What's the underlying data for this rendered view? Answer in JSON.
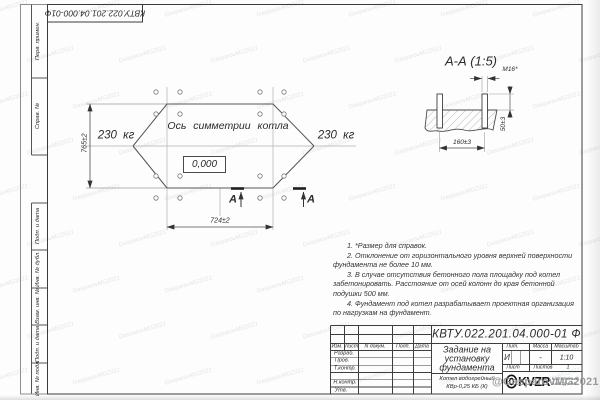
{
  "sheet": {
    "doc_number": "КВТУ.022.201.04.000-01 Ф",
    "doc_number_stamp": "КВТУ.022.201.04.000-01Ф"
  },
  "left_margin": {
    "upper": [
      "Перв. примен.",
      "Справ. №"
    ],
    "lower": [
      "Подп. и дата",
      "Инв. № дубл.",
      "Взам. инв. №",
      "Подп. и дата",
      "Инв. № подл."
    ]
  },
  "plan": {
    "axis_label": "Ось симметрии котла",
    "weight_left": "230 кг",
    "weight_right": "230 кг",
    "elevation_mark": "0,000",
    "dim_horizontal": "724±2",
    "dim_vertical": "765±2",
    "section_letter_left": "А",
    "section_letter_right": "А"
  },
  "section_view": {
    "title": "А-А (1:5)",
    "bolt_thread": "М16*",
    "dim_spacing": "160±3",
    "dim_height": "50±3"
  },
  "notes": [
    "1. *Размер для справок.",
    "2. Отклонение от горизонтального уровня верхней поверхности фундамента не более 10 мм.",
    "3. В случае отсутствия бетонного пола площадку под котел забетонировать. Расстояние от осей колонн до края бетонной подушки 500 мм.",
    "4. Фундамент под котел разрабатывает проектная организация по нагрузкам на фундамент."
  ],
  "title_block": {
    "header_cols": [
      "Изм.",
      "Лист",
      "N докум.",
      "Подп.",
      "Дата"
    ],
    "row_labels": [
      "Разраб.",
      "Пров.",
      "Т.контр.",
      "Н.контр.",
      "Утв."
    ],
    "title_lines": [
      "Задание на",
      "установку",
      "фундамента"
    ],
    "product_lines": [
      "Котел водогрейный",
      "КВр-0,25 КБ (К)"
    ],
    "lit_label": "Лит.",
    "lit_value": "И",
    "mass_label": "Масса",
    "mass_value": "-",
    "scale_label": "Масштаб",
    "scale_value": "1:10",
    "sheet_label": "Лист",
    "sheets_label": "Листов",
    "sheets_value": "1",
    "logo_text": "KVZR",
    "logo_sub": [
      "КОТЕЛЬНЫЙ",
      "ЗАВОД РЭП"
    ]
  },
  "watermark": {
    "main": "@GasparovMG2021",
    "tile": "GasparovMG2021"
  }
}
